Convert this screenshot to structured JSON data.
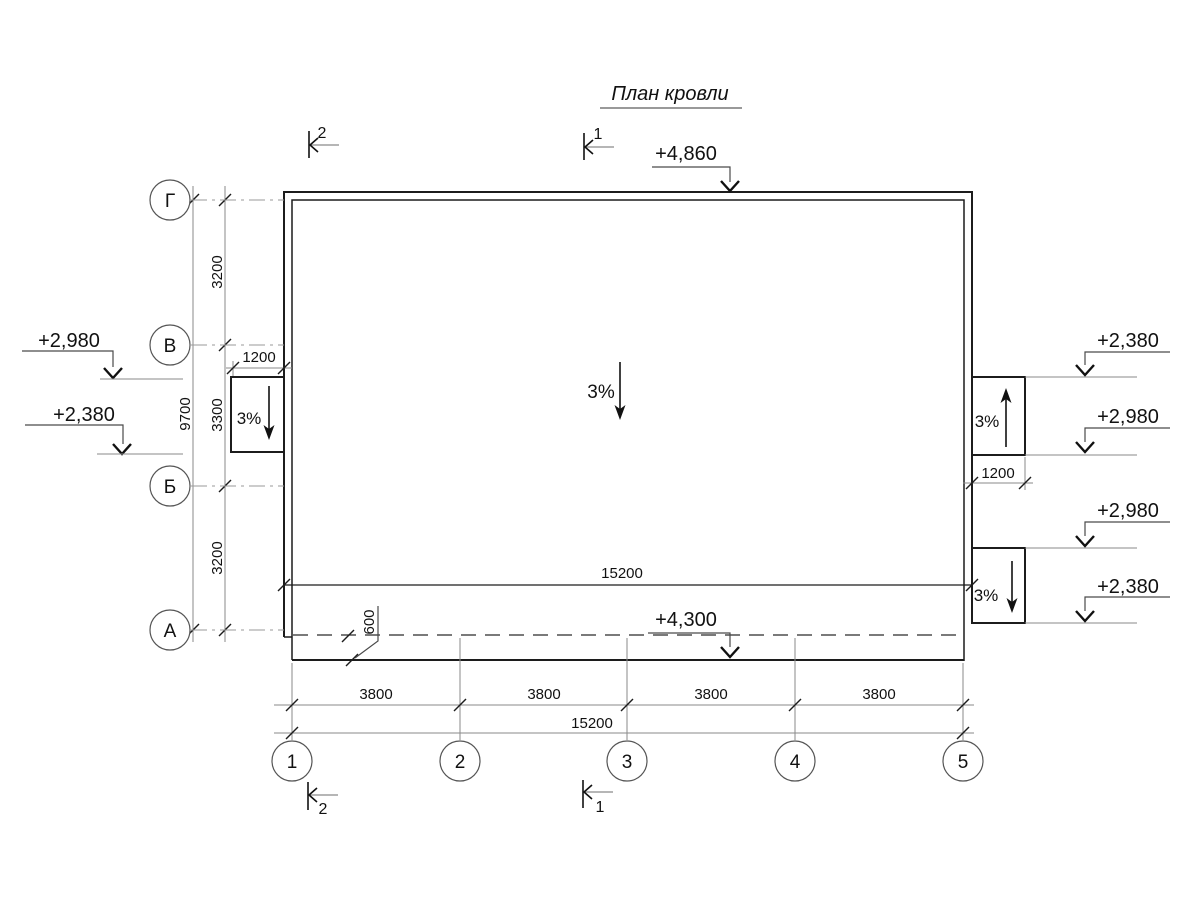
{
  "title": "План кровли",
  "drawing": {
    "row_axes": [
      "Г",
      "В",
      "Б",
      "А"
    ],
    "col_axes": [
      "1",
      "2",
      "3",
      "4",
      "5"
    ],
    "left_dims": {
      "segments": [
        "3200",
        "3300",
        "3200"
      ],
      "total": "9700"
    },
    "bottom_dims": {
      "segments": [
        "3800",
        "3800",
        "3800",
        "3800"
      ],
      "total": "15200"
    },
    "interior_width_dim": "15200",
    "left_canopy_dim": "1200",
    "right_canopy_dim": "1200",
    "overhang_dim": "600",
    "elevations": {
      "ridge": "+4,860",
      "eave": "+4,300",
      "left_top": "+2,980",
      "left_bottom": "+2,380",
      "right_1": "+2,380",
      "right_2": "+2,980",
      "right_3": "+2,980",
      "right_4": "+2,380"
    },
    "slopes": {
      "main": "3%",
      "left_canopy": "3%",
      "right_upper_canopy": "3%",
      "right_lower_canopy": "3%"
    },
    "sections": {
      "top_left": "2",
      "top_center": "1",
      "bottom_left": "2",
      "bottom_center": "1"
    }
  },
  "colors": {
    "line": "#1c1c1c",
    "thin": "#8a8a8a",
    "background": "#ffffff"
  }
}
